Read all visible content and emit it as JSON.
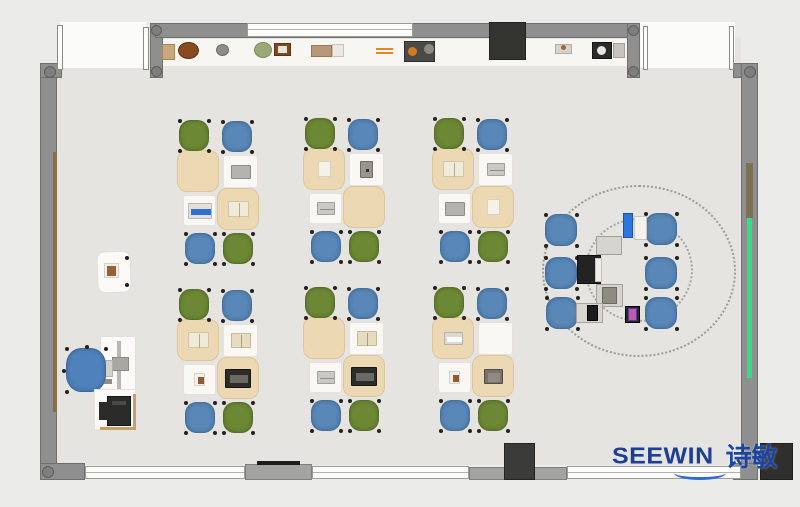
{
  "canvas": {
    "w": 800,
    "h": 507
  },
  "logo": {
    "text": "SEEWIN",
    "cn": "诗敏",
    "color": "#1c3f94",
    "swoosh_color": "#2f6cd0"
  },
  "palette": {
    "green": "#6d8834",
    "greenB": "#55702a",
    "blue": "#5887b8",
    "blueB": "#44709e",
    "tblue": "#4f82bb",
    "tblueB": "#3d6b9e",
    "tan": "#ecd8b2",
    "tanB": "#ddc69a",
    "deskWhite": "#f9f8f5",
    "deskWhiteB": "#e4e2db",
    "floor": "#e5e4e1",
    "outside": "#ebebea",
    "wall": "#8f8f8f",
    "wallB": "#6f6f6f",
    "accentGreen": "#2ee08c",
    "woodBrown": "#8a6f42"
  },
  "room": {
    "shapes": [
      {
        "n": "floor",
        "k": "rect",
        "x": 57,
        "y": 38,
        "w": 684,
        "h": 427,
        "f": "#e5e4e1"
      },
      {
        "n": "door-opening-left",
        "k": "rect",
        "x": 60,
        "y": 22,
        "w": 86,
        "h": 46,
        "f": "#fbfbfa"
      },
      {
        "n": "door-opening-right",
        "k": "rect",
        "x": 640,
        "y": 22,
        "w": 95,
        "h": 46,
        "f": "#fbfbfa"
      },
      {
        "n": "shelf-counter",
        "k": "rect",
        "x": 160,
        "y": 38,
        "w": 480,
        "h": 29,
        "f": "#f7f6f3",
        "b": "#e6e4de"
      },
      {
        "n": "wall-left",
        "k": "rect",
        "x": 40,
        "y": 63,
        "w": 17,
        "h": 417,
        "f": "#8f8f8f",
        "b": "#6f6f6f"
      },
      {
        "n": "wall-corner-topleft",
        "k": "rect",
        "x": 40,
        "y": 63,
        "w": 22,
        "h": 15,
        "f": "#8f8f8f",
        "b": "#6f6f6f"
      },
      {
        "n": "wall-stub-topleft",
        "k": "rect",
        "x": 150,
        "y": 23,
        "w": 13,
        "h": 55,
        "f": "#8f8f8f",
        "b": "#6f6f6f"
      },
      {
        "n": "wall-top",
        "k": "rect",
        "x": 155,
        "y": 23,
        "w": 485,
        "h": 15,
        "f": "#8f8f8f",
        "b": "#6f6f6f"
      },
      {
        "n": "wall-stub-topright",
        "k": "rect",
        "x": 627,
        "y": 23,
        "w": 13,
        "h": 55,
        "f": "#8f8f8f",
        "b": "#6f6f6f"
      },
      {
        "n": "wall-corner-topright",
        "k": "rect",
        "x": 733,
        "y": 63,
        "w": 25,
        "h": 15,
        "f": "#8f8f8f",
        "b": "#6f6f6f"
      },
      {
        "n": "wall-right",
        "k": "rect",
        "x": 741,
        "y": 63,
        "w": 17,
        "h": 417,
        "f": "#8f8f8f",
        "b": "#6f6f6f"
      },
      {
        "n": "wall-pier-bottomleft",
        "k": "rect",
        "x": 40,
        "y": 463,
        "w": 45,
        "h": 17,
        "f": "#8f8f8f",
        "b": "#6f6f6f"
      },
      {
        "n": "wall-pier-bottom-1",
        "k": "rect",
        "x": 245,
        "y": 464,
        "w": 67,
        "h": 16,
        "f": "#a3a3a1",
        "b": "#7f7f7d"
      },
      {
        "n": "wall-pier-bottom-2",
        "k": "rect",
        "x": 469,
        "y": 467,
        "w": 98,
        "h": 13,
        "f": "#a3a3a1",
        "b": "#7f7f7d"
      },
      {
        "n": "wall-pier-bottomright",
        "k": "rect",
        "x": 733,
        "y": 463,
        "w": 25,
        "h": 17,
        "f": "#8f8f8f",
        "b": "#6f6f6f"
      },
      {
        "n": "window-top-band",
        "k": "window",
        "x": 247,
        "y": 23,
        "w": 166,
        "h": 14
      },
      {
        "n": "window-bottom-1",
        "k": "window",
        "x": 85,
        "y": 466,
        "w": 160,
        "h": 13
      },
      {
        "n": "window-bottom-2",
        "k": "window",
        "x": 312,
        "y": 466,
        "w": 157,
        "h": 13
      },
      {
        "n": "window-bottom-3",
        "k": "window",
        "x": 567,
        "y": 466,
        "w": 174,
        "h": 13
      },
      {
        "n": "column",
        "k": "circle",
        "x": 44,
        "y": 66,
        "w": 12,
        "h": 12,
        "f": "#7e7e7e",
        "b": "#5f5f5f"
      },
      {
        "n": "column",
        "k": "circle",
        "x": 151,
        "y": 25,
        "w": 11,
        "h": 11,
        "f": "#7e7e7e",
        "b": "#5f5f5f"
      },
      {
        "n": "column",
        "k": "circle",
        "x": 151,
        "y": 66,
        "w": 11,
        "h": 11,
        "f": "#7e7e7e",
        "b": "#5f5f5f"
      },
      {
        "n": "column",
        "k": "circle",
        "x": 628,
        "y": 25,
        "w": 11,
        "h": 11,
        "f": "#7e7e7e",
        "b": "#5f5f5f"
      },
      {
        "n": "column",
        "k": "circle",
        "x": 628,
        "y": 66,
        "w": 11,
        "h": 11,
        "f": "#7e7e7e",
        "b": "#5f5f5f"
      },
      {
        "n": "column",
        "k": "circle",
        "x": 744,
        "y": 66,
        "w": 12,
        "h": 12,
        "f": "#7e7e7e",
        "b": "#5f5f5f"
      },
      {
        "n": "column",
        "k": "circle",
        "x": 42,
        "y": 466,
        "w": 12,
        "h": 12,
        "f": "#7e7e7e",
        "b": "#5f5f5f"
      },
      {
        "n": "door-panel",
        "k": "rect",
        "x": 57,
        "y": 25,
        "w": 6,
        "h": 45,
        "f": "#fdfdfc",
        "b": "#8a8a8a"
      },
      {
        "n": "door-panel",
        "k": "rect",
        "x": 143,
        "y": 27,
        "w": 6,
        "h": 43,
        "f": "#fdfdfc",
        "b": "#8a8a8a"
      },
      {
        "n": "door-panel",
        "k": "rect",
        "x": 643,
        "y": 26,
        "w": 5,
        "h": 44,
        "f": "#fdfdfc",
        "b": "#8a8a8a"
      },
      {
        "n": "door-panel",
        "k": "rect",
        "x": 729,
        "y": 26,
        "w": 5,
        "h": 44,
        "f": "#fdfdfc",
        "b": "#8a8a8a"
      },
      {
        "n": "wall-board-left",
        "k": "rect",
        "x": 53,
        "y": 152,
        "w": 4,
        "h": 260,
        "f": "#8a6f42"
      },
      {
        "n": "wall-trim-right-brown",
        "k": "rect",
        "x": 746,
        "y": 163,
        "w": 7,
        "h": 55,
        "f": "#7b7252"
      },
      {
        "n": "wall-strip-right-green",
        "k": "rect",
        "x": 747,
        "y": 218,
        "w": 5,
        "h": 160,
        "f": "#2ee08c"
      },
      {
        "n": "bench-line",
        "k": "rect",
        "x": 257,
        "y": 461,
        "w": 43,
        "h": 4,
        "f": "#1c1c1c"
      },
      {
        "n": "tv-cabinet-top",
        "k": "rect",
        "x": 489,
        "y": 22,
        "w": 37,
        "h": 38,
        "f": "#333330",
        "b": "#232320"
      },
      {
        "n": "cabinet-bottom-center",
        "k": "rect",
        "x": 504,
        "y": 443,
        "w": 31,
        "h": 37,
        "f": "#3b3b39",
        "b": "#232322"
      },
      {
        "n": "cabinet-bottom-right",
        "k": "rect",
        "x": 760,
        "y": 443,
        "w": 33,
        "h": 37,
        "f": "#2f2f2d",
        "b": "#1f1f1e"
      }
    ]
  },
  "shelf_items": [
    {
      "n": "decor-basket",
      "k": "rect",
      "x": 162,
      "y": 44,
      "w": 13,
      "h": 16,
      "f": "#c9a87c",
      "b": "#a9855c"
    },
    {
      "n": "decor-bowl",
      "k": "circle",
      "x": 178,
      "y": 42,
      "w": 21,
      "h": 17,
      "f": "#8a4a1f",
      "b": "#5e3012"
    },
    {
      "n": "decor-stone",
      "k": "circle",
      "x": 216,
      "y": 44,
      "w": 13,
      "h": 12,
      "f": "#8e8c86",
      "b": "#6f6d67"
    },
    {
      "n": "decor-plant",
      "k": "circle",
      "x": 254,
      "y": 42,
      "w": 18,
      "h": 16,
      "f": "#9aa877",
      "b": "#7a8a55"
    },
    {
      "n": "decor-frame",
      "k": "rect",
      "x": 274,
      "y": 43,
      "w": 17,
      "h": 13,
      "f": "#7a4a22",
      "b": "#5a330f"
    },
    {
      "n": "decor-frame-photo",
      "k": "rect",
      "x": 278,
      "y": 46,
      "w": 9,
      "h": 7,
      "f": "#e8e4da"
    },
    {
      "n": "decor-box",
      "k": "rect",
      "x": 311,
      "y": 45,
      "w": 21,
      "h": 12,
      "f": "#b9987a",
      "b": "#997852"
    },
    {
      "n": "decor-book-stack",
      "k": "rect",
      "x": 332,
      "y": 44,
      "w": 12,
      "h": 13,
      "f": "#ece9e2",
      "b": "#c8c4ba"
    },
    {
      "n": "decor-stick",
      "k": "rect",
      "x": 376,
      "y": 48,
      "w": 17,
      "h": 2,
      "f": "#e0862a"
    },
    {
      "n": "decor-stick",
      "k": "rect",
      "x": 376,
      "y": 52,
      "w": 17,
      "h": 2,
      "f": "#e0862a"
    },
    {
      "n": "decor-kit",
      "k": "rect",
      "x": 404,
      "y": 41,
      "w": 31,
      "h": 21,
      "f": "#4a4a46",
      "b": "#2e2e2a"
    },
    {
      "n": "decor-kit-dot-orange",
      "k": "circle",
      "x": 408,
      "y": 47,
      "w": 9,
      "h": 9,
      "f": "#d07a28"
    },
    {
      "n": "decor-kit-dot-gray",
      "k": "circle",
      "x": 424,
      "y": 44,
      "w": 10,
      "h": 10,
      "f": "#8c8a82"
    },
    {
      "n": "decor-tray",
      "k": "rect",
      "x": 555,
      "y": 44,
      "w": 17,
      "h": 10,
      "f": "#d6d3cc",
      "b": "#b1aea6"
    },
    {
      "n": "decor-tray-dot",
      "k": "circle",
      "x": 561,
      "y": 45,
      "w": 5,
      "h": 5,
      "f": "#9a6b3a"
    },
    {
      "n": "appliance",
      "k": "rect",
      "x": 592,
      "y": 42,
      "w": 20,
      "h": 17,
      "f": "#2b2b29",
      "b": "#151513"
    },
    {
      "n": "appliance-dial",
      "k": "circle",
      "x": 597,
      "y": 46,
      "w": 9,
      "h": 9,
      "f": "#e8e6e0"
    },
    {
      "n": "appliance-rack",
      "k": "rect",
      "x": 613,
      "y": 43,
      "w": 12,
      "h": 15,
      "f": "#c6c3bc",
      "b": "#a5a29a"
    }
  ],
  "cluster_template": {
    "chairs": [
      {
        "dx": 2,
        "dy": 2,
        "w": 30,
        "h": 31,
        "c": "green",
        "pos": "top-left"
      },
      {
        "dx": 45,
        "dy": 3,
        "w": 30,
        "h": 31,
        "c": "blue",
        "pos": "top-right"
      },
      {
        "dx": 8,
        "dy": 115,
        "w": 30,
        "h": 31,
        "c": "blue",
        "pos": "bottom-left"
      },
      {
        "dx": 46,
        "dy": 115,
        "w": 30,
        "h": 31,
        "c": "green",
        "pos": "bottom-right"
      }
    ],
    "desks": [
      {
        "dx": 0,
        "dy": 32,
        "w": 42,
        "h": 42,
        "f": "tan",
        "r": 10
      },
      {
        "dx": 46,
        "dy": 37,
        "w": 35,
        "h": 33,
        "f": "deskWhite",
        "r": 3
      },
      {
        "dx": 6,
        "dy": 77,
        "w": 33,
        "h": 31,
        "f": "deskWhite",
        "r": 3
      },
      {
        "dx": 40,
        "dy": 70,
        "w": 42,
        "h": 42,
        "f": "tan",
        "r": 10
      }
    ]
  },
  "item_styles": {
    "laptop-gray": {
      "w": 20,
      "h": 14,
      "f": "#b5b3ae",
      "b": "#8e8c86"
    },
    "laptop-blue": {
      "w": 24,
      "h": 16,
      "f": "#e3e1dc",
      "b": "#bcb9b2",
      "iw": 20,
      "ih": 6,
      "if": "#2d6fd2"
    },
    "laptop-dark": {
      "w": 26,
      "h": 19,
      "f": "#2c2c2a",
      "b": "#161614",
      "iw": 18,
      "ih": 8,
      "if": "#6b6965"
    },
    "book-pen": {
      "w": 21,
      "h": 16,
      "f": "#f0ead8",
      "b": "#cfc6a8",
      "iw": 1,
      "ih": 14,
      "if": "#b5ab8a"
    },
    "book-open": {
      "w": 20,
      "h": 15,
      "f": "#e6dcc2",
      "b": "#c6ba97",
      "iw": 1,
      "ih": 13,
      "if": "#af9f78"
    },
    "book-gray": {
      "w": 18,
      "h": 13,
      "f": "#cbc9c4",
      "b": "#a2a09a",
      "iw": 14,
      "ih": 1,
      "if": "#8f8d87"
    },
    "paper": {
      "w": 13,
      "h": 16,
      "f": "#f4f1e9",
      "b": "#d9d3c3"
    },
    "tablet": {
      "w": 13,
      "h": 17,
      "f": "#97958d",
      "b": "#6d6b63",
      "iw": 3,
      "ih": 3,
      "if": "#2e2e2a"
    },
    "photo": {
      "w": 11,
      "h": 13,
      "f": "#f5f2ea",
      "b": "#d8d2c4",
      "iw": 6,
      "ih": 7,
      "if": "#8f5b35"
    },
    "keyboard": {
      "w": 19,
      "h": 13,
      "f": "#dcd9d3",
      "b": "#b5b2ab",
      "iw": 15,
      "ih": 5,
      "if": "#fbfbfa"
    },
    "book-dark": {
      "w": 19,
      "h": 15,
      "f": "#77736c",
      "b": "#514e48",
      "iw": 12,
      "ih": 9,
      "if": "#8f8b84"
    }
  },
  "clusters": [
    {
      "n": "desk-cluster-1",
      "x": 177,
      "y": 118,
      "items": [
        "none",
        "laptop-gray",
        "laptop-blue",
        "book-pen"
      ]
    },
    {
      "n": "desk-cluster-2",
      "x": 303,
      "y": 116,
      "items": [
        "paper",
        "tablet",
        "book-gray",
        "none"
      ]
    },
    {
      "n": "desk-cluster-3",
      "x": 432,
      "y": 116,
      "items": [
        "book-pen",
        "book-gray",
        "laptop-gray",
        "paper"
      ]
    },
    {
      "n": "desk-cluster-4",
      "x": 177,
      "y": 287,
      "items": [
        "book-pen",
        "book-open",
        "photo",
        "laptop-dark"
      ]
    },
    {
      "n": "desk-cluster-5",
      "x": 303,
      "y": 285,
      "items": [
        "none",
        "book-open",
        "book-gray",
        "laptop-dark"
      ]
    },
    {
      "n": "desk-cluster-6",
      "x": 432,
      "y": 285,
      "items": [
        "keyboard",
        "none",
        "photo",
        "book-dark"
      ]
    }
  ],
  "collab": {
    "zone_outline": {
      "n": "collab-zone-outline",
      "k": "ellipse",
      "x": 542,
      "y": 185,
      "w": 194,
      "h": 172,
      "b": "#9c9c97"
    },
    "zone_inner": {
      "n": "collab-zone-inner",
      "k": "ellipse",
      "x": 585,
      "y": 218,
      "w": 108,
      "h": 104,
      "b": "#a5a5a0"
    },
    "chairs": [
      {
        "x": 545,
        "y": 214,
        "w": 32,
        "h": 32,
        "c": "blue"
      },
      {
        "x": 545,
        "y": 257,
        "w": 32,
        "h": 32,
        "c": "blue"
      },
      {
        "x": 546,
        "y": 297,
        "w": 32,
        "h": 32,
        "c": "blue"
      },
      {
        "x": 645,
        "y": 213,
        "w": 32,
        "h": 32,
        "c": "blue"
      },
      {
        "x": 645,
        "y": 257,
        "w": 32,
        "h": 32,
        "c": "blue"
      },
      {
        "x": 645,
        "y": 297,
        "w": 32,
        "h": 32,
        "c": "blue"
      }
    ],
    "devices": [
      {
        "n": "tablet",
        "k": "rect",
        "x": 623,
        "y": 213,
        "w": 10,
        "h": 25,
        "f": "#2c76dd",
        "b": "#1d52a8"
      },
      {
        "n": "notepad",
        "k": "rect",
        "x": 634,
        "y": 216,
        "w": 13,
        "h": 24,
        "f": "#f3f2ef",
        "b": "#c9c6c0"
      },
      {
        "n": "device-tray",
        "k": "rect",
        "x": 596,
        "y": 236,
        "w": 26,
        "h": 19,
        "f": "#d6d4cf",
        "b": "#a3a09a"
      },
      {
        "n": "laptop-dark",
        "k": "rect",
        "x": 577,
        "y": 255,
        "w": 24,
        "h": 29,
        "f": "#232323",
        "b": "#0f0f0f"
      },
      {
        "n": "laptop-screen",
        "k": "rect",
        "x": 595,
        "y": 258,
        "w": 7,
        "h": 24,
        "f": "#efeeea",
        "b": "#c5c2bc"
      },
      {
        "n": "device-tray",
        "k": "rect",
        "x": 596,
        "y": 284,
        "w": 27,
        "h": 23,
        "f": "#d6d4cf",
        "b": "#a3a09a"
      },
      {
        "n": "tray-item",
        "k": "rect",
        "x": 602,
        "y": 287,
        "w": 15,
        "h": 17,
        "f": "#8e8b84",
        "b": "#6b6862"
      },
      {
        "n": "laptop-open",
        "k": "rect",
        "x": 576,
        "y": 303,
        "w": 27,
        "h": 20,
        "f": "#d8d6d1",
        "b": "#a8a5a0"
      },
      {
        "n": "laptop-screen-dark",
        "k": "rect",
        "x": 587,
        "y": 305,
        "w": 11,
        "h": 16,
        "f": "#1c1c1c",
        "b": "#000000"
      },
      {
        "n": "phone",
        "k": "rect",
        "x": 625,
        "y": 306,
        "w": 15,
        "h": 17,
        "f": "#262626",
        "b": "#000000"
      },
      {
        "n": "phone-screen",
        "k": "rect",
        "x": 628,
        "y": 308,
        "w": 9,
        "h": 13,
        "f": "#c257a8",
        "b": "#5a3a9a"
      }
    ]
  },
  "teacher": {
    "shapes": [
      {
        "n": "side-desk",
        "k": "rect",
        "x": 97,
        "y": 251,
        "w": 34,
        "h": 42,
        "f": "#fbfaf8",
        "b": "#e2dfd9",
        "r": 8,
        "rot": -2
      },
      {
        "n": "side-desk-knob",
        "k": "circle",
        "x": 125,
        "y": 256,
        "w": 4,
        "h": 4,
        "f": "#1f1f1f"
      },
      {
        "n": "side-desk-knob",
        "k": "circle",
        "x": 125,
        "y": 283,
        "w": 4,
        "h": 4,
        "f": "#1f1f1f"
      },
      {
        "n": "side-desk-photo",
        "k": "rect",
        "x": 104,
        "y": 263,
        "w": 15,
        "h": 15,
        "f": "#f2efe8",
        "b": "#d8d3c8"
      },
      {
        "n": "side-desk-photo-inner",
        "k": "rect",
        "x": 107,
        "y": 266,
        "w": 9,
        "h": 10,
        "f": "#96603a"
      },
      {
        "n": "teacher-desk",
        "k": "rect",
        "x": 100,
        "y": 336,
        "w": 36,
        "h": 60,
        "f": "#fbfaf8",
        "b": "#e2dfd9",
        "r": 3
      },
      {
        "n": "monitor-arm",
        "k": "rect",
        "x": 117,
        "y": 341,
        "w": 4,
        "h": 51,
        "f": "#b9b7b2"
      },
      {
        "n": "monitor",
        "k": "rect",
        "x": 112,
        "y": 357,
        "w": 17,
        "h": 14,
        "f": "#a9a7a1",
        "b": "#8b8984"
      },
      {
        "n": "keyboard",
        "k": "rect",
        "x": 104,
        "y": 360,
        "w": 9,
        "h": 17,
        "f": "#d4d2cd",
        "b": "#b3b1ab"
      },
      {
        "n": "mouse",
        "k": "rect",
        "x": 104,
        "y": 379,
        "w": 8,
        "h": 5,
        "f": "#8f8d88"
      },
      {
        "n": "teacher-chair",
        "k": "chair5",
        "x": 66,
        "y": 348,
        "w": 40,
        "h": 44,
        "c": "tblue"
      },
      {
        "n": "printer-table",
        "k": "rect",
        "x": 94,
        "y": 389,
        "w": 42,
        "h": 41,
        "f": "#fbfaf8",
        "b": "#e5e2dc"
      },
      {
        "n": "printer-table-edge",
        "k": "rect",
        "x": 133,
        "y": 394,
        "w": 3,
        "h": 36,
        "f": "#c99f63"
      },
      {
        "n": "printer-table-edge",
        "k": "rect",
        "x": 100,
        "y": 427,
        "w": 36,
        "h": 3,
        "f": "#c99f63"
      },
      {
        "n": "printer",
        "k": "rect",
        "x": 107,
        "y": 396,
        "w": 24,
        "h": 30,
        "f": "#2b2b2a",
        "b": "#141413"
      },
      {
        "n": "printer-wing",
        "k": "rect",
        "x": 99,
        "y": 402,
        "w": 12,
        "h": 18,
        "f": "#2b2b2a"
      },
      {
        "n": "printer-slot",
        "k": "rect",
        "x": 112,
        "y": 401,
        "w": 14,
        "h": 4,
        "f": "#4a4a48"
      }
    ]
  }
}
